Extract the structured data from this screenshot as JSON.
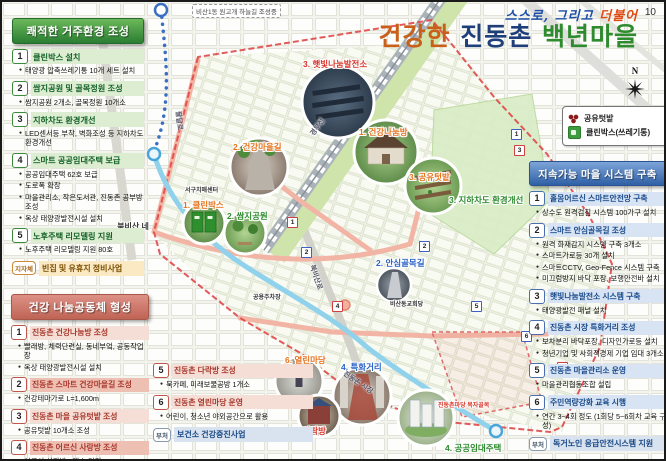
{
  "page_number": "10",
  "title": {
    "line1": "스스로, 그리고 ",
    "line1_accent": "더불어",
    "line2_seg1": "건강한 ",
    "line2_seg2": "진동촌 ",
    "line2_seg3": "백년마을"
  },
  "compass_label": "N",
  "legend": {
    "items": [
      {
        "icon": "shared-garden-icon",
        "label": "공유텃밭"
      },
      {
        "icon": "clean-box-icon",
        "label": "클린박스(쓰레기통)"
      }
    ]
  },
  "panels": {
    "left_top": {
      "header": "쾌적한 거주환경 조성",
      "items": [
        {
          "num": "1",
          "title": "클린박스 설치",
          "bullets": [
            "태양광 압축쓰레기통 10개 세트 설치"
          ]
        },
        {
          "num": "2",
          "title": "쌈지공원 및 골목정원 조성",
          "bullets": [
            "쌈지공원 2개소, 골목정원 10개소"
          ]
        },
        {
          "num": "3",
          "title": "지하차도 환경개선",
          "bullets": [
            "LED센서등 부착, 벽화조성 등 지하차도 환경개선"
          ]
        },
        {
          "num": "4",
          "title": "스마트 공공임대주택 보급",
          "bullets": [
            "공공임대주택 62호 보급",
            "도로폭 확장",
            "마을관리소, 작은도서관, 진동촌 공부방 조성",
            "옥상 태양광발전시설 설치"
          ]
        },
        {
          "num": "5",
          "title": "노후주택 리모델링 지원",
          "bullets": [
            "노후주택 리모델링 지원 80호"
          ]
        }
      ],
      "tag_item": {
        "tag": "지자체",
        "label": "빈집 및 유휴지 정비사업"
      }
    },
    "left_bottom": {
      "header": "건강 나눔공동체 형성",
      "items": [
        {
          "num": "1",
          "title": "진동촌 건강나눔방 조성",
          "bullets": [
            "빨래방, 체력단련실, 동네부엌, 공동작업장",
            "옥상 태양광발전시설 설치"
          ]
        },
        {
          "num": "2",
          "title": "진동촌 스마트 건강마을길 조성",
          "hl": true,
          "bullets": [
            "건강테마가로 L=1,600m"
          ]
        },
        {
          "num": "3",
          "title": "진동촌 마을 공유텃밭 조성",
          "bullets": [
            "공유텃밭 10개소 조성"
          ]
        },
        {
          "num": "4",
          "title": "진동촌 어르신 사랑방 조성",
          "hl": true,
          "bullets": [
            "어르신 사랑방 1개소 건립"
          ]
        }
      ]
    },
    "bottom_mid": {
      "items": [
        {
          "num": "5",
          "title": "진동촌 다락방 조성",
          "bullets": [
            "북카페, 미래보물공방 1개소"
          ]
        },
        {
          "num": "6",
          "title": "진동촌 열린마당 운영",
          "bullets": [
            "어린이, 청소년 야외공간으로 활용"
          ]
        }
      ],
      "tag_item": {
        "tag": "부처",
        "label": "보건소 건강증진사업"
      }
    },
    "right": {
      "header": "지속가능 마을 시스템 구축",
      "items": [
        {
          "num": "1",
          "title": "홀몸어르신 스마트안전망 구축",
          "bullets": [
            "상수도 원격검침 시스템 100가구 설치"
          ]
        },
        {
          "num": "2",
          "title": "스마트 안심골목길 조성",
          "bullets": [
            "원격 화재감지 시스템 구축 3개소",
            "스마트가로등 30개 설치",
            "스마트CCTV, Geo-Fence 시스템 구축",
            "미끄럼방지 바닥 포장, 보행안전바 설치"
          ]
        },
        {
          "num": "3",
          "title": "햇빛나눔발전소 시스템 구축",
          "bullets": [
            "태양광발전 패널 설치"
          ]
        },
        {
          "num": "4",
          "title": "진동촌 시장 특화거리 조성",
          "bullets": [
            "보차분리 바닥포장, 디자인가로등 설치",
            "청년기업 및 사회적경제 기업 임대 3개소"
          ]
        },
        {
          "num": "5",
          "title": "진동촌 마을관리소 운영",
          "bullets": [
            "마을관리협동조합 설립"
          ]
        },
        {
          "num": "6",
          "title": "주민역량강화 교육 시행",
          "bullets": [
            "연간 3~4회 정도 (1회당 5~6회차 교육 구성)"
          ]
        }
      ],
      "tag_item": {
        "tag": "부처",
        "label": "독거노인 응급안전시스템 지원"
      }
    }
  },
  "map": {
    "banner": "비산1동 원고개 하늘길 조성중",
    "labels": [
      {
        "text": "3. 햇빛나눔발전소",
        "x": 301,
        "y": 56,
        "color": "red"
      },
      {
        "text": "2. 건강마을길",
        "x": 231,
        "y": 139,
        "color": "orange"
      },
      {
        "text": "1. 건강나눔방",
        "x": 357,
        "y": 124,
        "color": "orange"
      },
      {
        "text": "3. 공유텃밭",
        "x": 407,
        "y": 169,
        "color": "orange"
      },
      {
        "text": "3. 지하차도 환경개선",
        "x": 447,
        "y": 192,
        "color": "green"
      },
      {
        "text": "서구치매센터",
        "x": 183,
        "y": 183,
        "color": "dark",
        "small": true
      },
      {
        "text": "1. 클린박스",
        "x": 181,
        "y": 197,
        "color": "orange"
      },
      {
        "text": "2. 쌈지공원",
        "x": 225,
        "y": 208,
        "color": "green"
      },
      {
        "text": "북비산 네거리",
        "x": 112,
        "y": 220,
        "color": "dark",
        "wrap": true
      },
      {
        "text": "2. 안심골목길",
        "x": 374,
        "y": 255,
        "color": "blue"
      },
      {
        "text": "공용주차장",
        "x": 251,
        "y": 290,
        "color": "dark",
        "small": true
      },
      {
        "text": "비산동교회당",
        "x": 388,
        "y": 297,
        "color": "dark",
        "small": true
      },
      {
        "text": "6. 열린마당",
        "x": 283,
        "y": 352,
        "color": "orange"
      },
      {
        "text": "4. 특화거리",
        "x": 339,
        "y": 359,
        "color": "blue"
      },
      {
        "text": "5. 다락방",
        "x": 291,
        "y": 423,
        "color": "red"
      },
      {
        "text": "4. 공공임대주택",
        "x": 443,
        "y": 440,
        "color": "green"
      },
      {
        "text": "진동촌마당 목자골목",
        "x": 436,
        "y": 398,
        "color": "red",
        "small": true
      }
    ],
    "road_labels": [
      {
        "text": "경부선",
        "x": 310,
        "y": 128,
        "rot": -55
      },
      {
        "text": "북비산로",
        "x": 310,
        "y": 258,
        "rot": 72
      },
      {
        "text": "팔달로",
        "x": 176,
        "y": 104,
        "rot": 84
      },
      {
        "text": "진동촌 시장",
        "x": 342,
        "y": 366,
        "rot": 34
      }
    ],
    "markers": [
      {
        "n": "1",
        "x": 285,
        "y": 215,
        "c": "red"
      },
      {
        "n": "2",
        "x": 299,
        "y": 245,
        "c": "blue"
      },
      {
        "n": "1",
        "x": 509,
        "y": 127,
        "c": "blue"
      },
      {
        "n": "3",
        "x": 512,
        "y": 143,
        "c": "red"
      },
      {
        "n": "2",
        "x": 417,
        "y": 239,
        "c": "blue"
      },
      {
        "n": "4",
        "x": 330,
        "y": 299,
        "c": "red"
      },
      {
        "n": "5",
        "x": 469,
        "y": 299,
        "c": "blue"
      },
      {
        "n": "6",
        "x": 519,
        "y": 329,
        "c": "blue"
      },
      {
        "n": "4",
        "x": 555,
        "y": 360,
        "c": "red"
      }
    ]
  }
}
